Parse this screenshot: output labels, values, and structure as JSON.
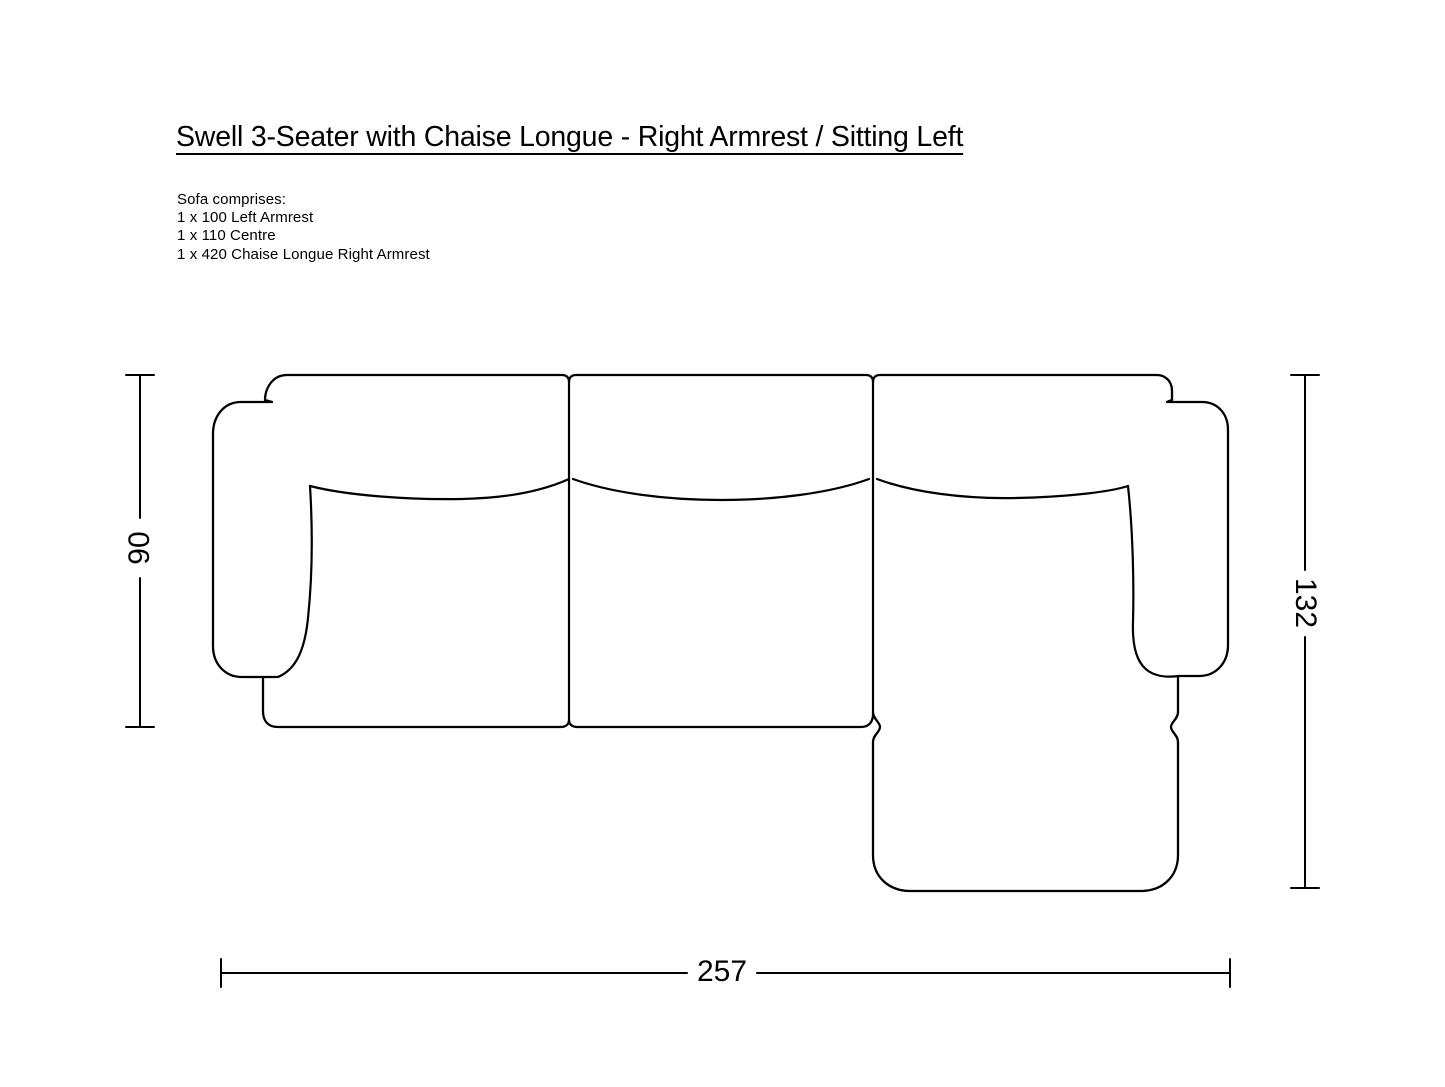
{
  "title": "Swell 3-Seater with Chaise Longue - Right Armrest / Sitting Left",
  "composition": {
    "heading": "Sofa comprises:",
    "items": [
      "1 x 100 Left Armrest",
      "1 x 110 Centre",
      "1 x 420 Chaise Longue Right Armrest"
    ]
  },
  "dimensions": {
    "sofa_depth": "90",
    "chaise_depth": "132",
    "total_width": "257"
  },
  "colors": {
    "background": "#ffffff",
    "line": "#000000"
  }
}
